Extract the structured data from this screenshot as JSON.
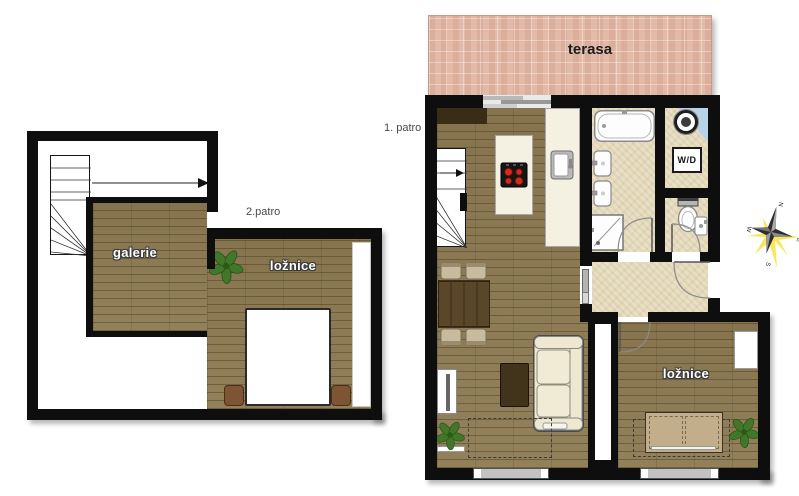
{
  "title": "apartment floor plan",
  "floor2": {
    "floor_label": "2.patro",
    "galerie_label": "galerie",
    "loznice_label": "ložnice"
  },
  "floor1": {
    "floor_label": "1. patro",
    "terasa_label": "terasa",
    "loznice_label": "ložnice",
    "wd_label": "W/D"
  },
  "compass": {
    "n": "N",
    "e": "E",
    "s": "S",
    "w": "W"
  },
  "icons": {
    "stairs": "stairs-icon",
    "plant": "plant-icon",
    "compass_rose": "compass-rose-icon",
    "washing_machine": "washing-machine-icon",
    "bathtub": "bathtub-icon",
    "sink": "sink-icon",
    "shower": "shower-icon",
    "toilet": "toilet-icon",
    "stove": "stove-icon",
    "kitchen_sink": "kitchen-sink-icon",
    "sofa": "sofa-icon",
    "bed": "bed-icon",
    "dining_set": "dining-set-icon",
    "window": "window-icon",
    "door_swing": "door-arc-icon"
  },
  "colors": {
    "wall": "#0e0e0e",
    "wood_floor": "#8d7a52",
    "tile_floor": "#e8dfc4",
    "terrace_brick": "#e3b9a7",
    "wd_blue": "#b7d3e6",
    "counter_cream": "#f4f0e2",
    "sofa_cream": "#eee8d2",
    "table_wood": "#5a4629",
    "coffee_table": "#42341a",
    "chair_tan": "#c8bb9e",
    "bed_tan": "#c3ae8c",
    "nightstand_brown": "#7d5434",
    "stove_black": "#161616",
    "burner_red": "#d02c1c",
    "plant_green": "#41762b",
    "window_gray": "#c2c2c2",
    "compass_yellow": "#f7e33e",
    "label_gray": "#4a4a4a"
  }
}
